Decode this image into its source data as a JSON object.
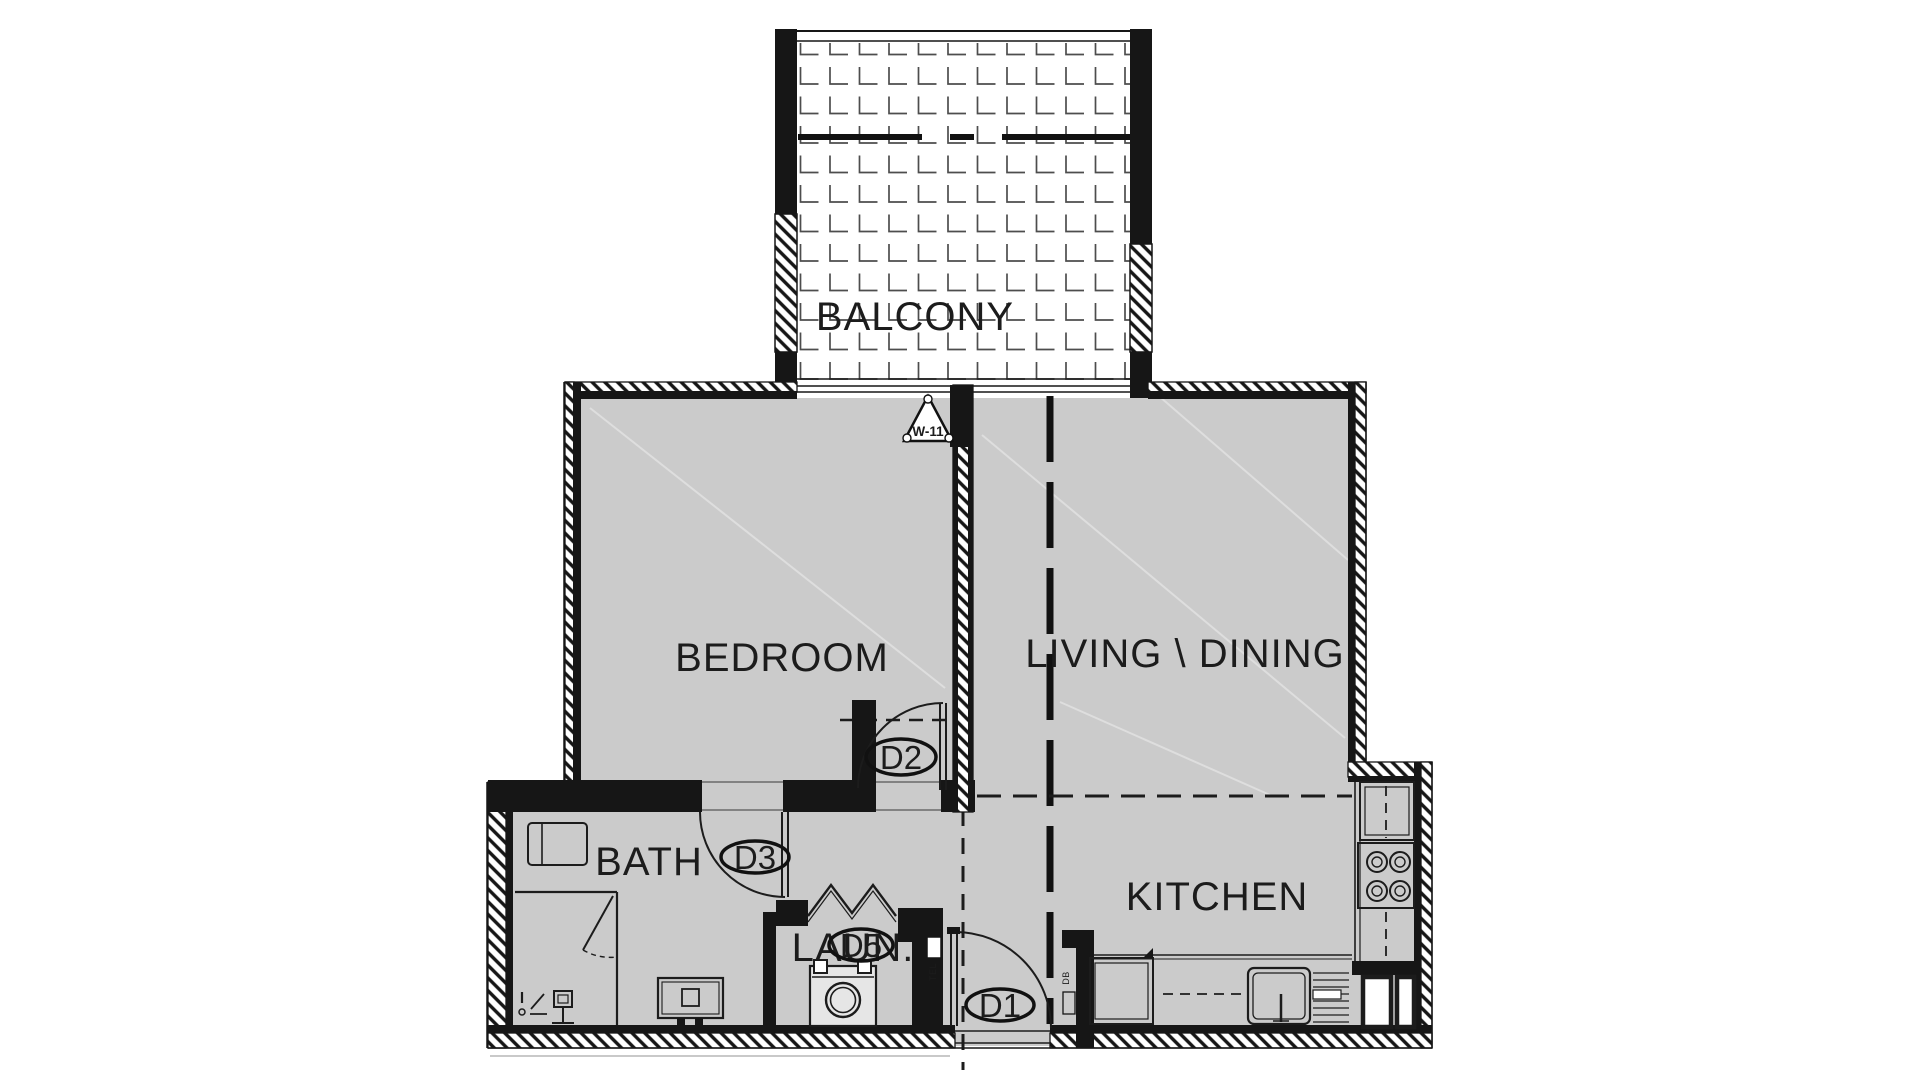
{
  "floor_plan": {
    "rooms": [
      {
        "id": "balcony",
        "label": "BALCONY"
      },
      {
        "id": "bedroom",
        "label": "BEDROOM"
      },
      {
        "id": "living_dining",
        "label": "LIVING \\ DINING"
      },
      {
        "id": "bath",
        "label": "BATH"
      },
      {
        "id": "laundry",
        "label": "LAUN."
      },
      {
        "id": "kitchen",
        "label": "KITCHEN"
      }
    ],
    "door_tags": [
      {
        "id": "D1",
        "label": "D1"
      },
      {
        "id": "D2",
        "label": "D2"
      },
      {
        "id": "D3",
        "label": "D3"
      },
      {
        "id": "D5",
        "label": "D5"
      }
    ],
    "window_tags": [
      {
        "id": "W-11",
        "label": "W-11"
      }
    ],
    "utility_labels": [
      {
        "id": "tel",
        "label": "TEL"
      },
      {
        "id": "db",
        "label": "DB"
      }
    ],
    "colors": {
      "background": "#ffffff",
      "floor": "#cbcbcb",
      "wall": "#161616",
      "tile_line": "#4d4d4d",
      "faint_line": "#dedede"
    }
  }
}
